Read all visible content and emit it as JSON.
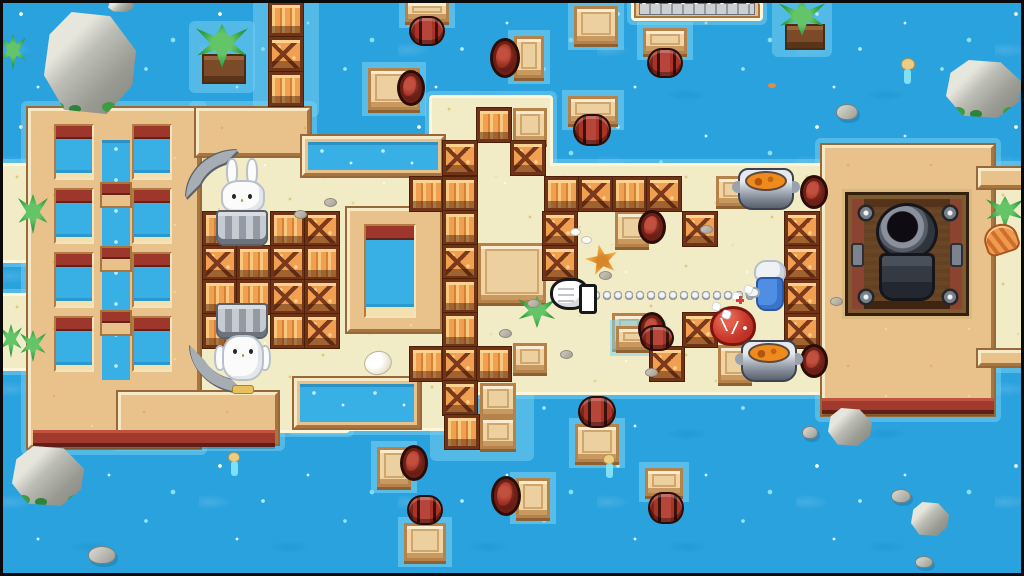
{
  "meta": {
    "description": "Top-down pixel-art beach arena game scene: sand island in blue water with crates, barrels, rafts, rabbits in buckets, a knight firing a spring boxing glove at a red slime, soup pots and a cannon",
    "canvas": {
      "w": 1024,
      "h": 576
    }
  },
  "palette": {
    "water": "#2aa2de",
    "water_sparkle": "#aeeffb",
    "shallow_glow": "#74ceee",
    "sand": "#f2ecc6",
    "sand_rim": "#fcf6dc",
    "wood_platform": "#e9c18a",
    "platform_edge_maroon": "#a03a2c",
    "crate_orange": "#f0a050",
    "crate_frame": "#6f3318",
    "barrel_red": "#a83326",
    "pool_water": "#38b0e6",
    "rock_gray": "#b8b9b1",
    "leaf_green": "#2f9e44",
    "metal_gray": "#a7adb4",
    "knight_blue": "#4f8ee2",
    "slime_red": "#c8392b",
    "soup_orange": "#ef8a1d",
    "rabbit_white": "#fbfbfb",
    "bucket_gray": "#949aa3"
  },
  "scene": {
    "islands": [
      [
        187,
        148,
        160,
        282
      ],
      [
        306,
        166,
        534,
        226
      ],
      [
        432,
        98,
        118,
        80
      ],
      [
        294,
        376,
        152,
        52
      ],
      [
        986,
        184,
        38,
        172
      ],
      [
        0,
        166,
        48,
        94
      ],
      [
        0,
        296,
        42,
        72
      ],
      [
        634,
        0,
        126,
        18
      ]
    ],
    "platforms": [
      [
        28,
        108,
        172,
        340
      ],
      [
        196,
        108,
        114,
        48
      ],
      [
        118,
        392,
        160,
        52
      ],
      [
        822,
        145,
        172,
        270
      ],
      [
        978,
        168,
        46,
        20
      ],
      [
        978,
        350,
        46,
        16
      ]
    ],
    "glow_extra": [
      [
        260,
        0,
        52,
        110
      ],
      [
        437,
        374,
        90,
        80
      ],
      [
        196,
        28,
        52,
        58
      ],
      [
        779,
        0,
        46,
        50
      ]
    ],
    "objects": [
      {
        "type": "pier",
        "items": [
          [
            634,
            0,
            126,
            18
          ]
        ]
      },
      {
        "type": "tan",
        "items": [
          [
            302,
            136,
            142,
            40
          ],
          [
            294,
            378,
            126,
            50
          ],
          [
            347,
            208,
            96,
            124
          ]
        ]
      },
      {
        "type": "maroon",
        "items": [
          [
            33,
            430,
            242,
            17
          ],
          [
            822,
            398,
            172,
            16
          ]
        ]
      },
      {
        "type": "poolw",
        "items": [
          [
            308,
            142,
            130,
            28
          ],
          [
            300,
            384,
            114,
            38
          ],
          [
            102,
            140,
            28,
            240
          ]
        ]
      },
      {
        "type": "bridge",
        "items": [
          [
            100,
            182
          ],
          [
            100,
            246
          ],
          [
            100,
            310
          ]
        ]
      },
      {
        "type": "window",
        "items": [
          [
            54,
            124
          ],
          [
            132,
            124
          ],
          [
            54,
            188
          ],
          [
            132,
            188
          ],
          [
            54,
            252
          ],
          [
            132,
            252
          ],
          [
            54,
            316
          ],
          [
            132,
            316
          ]
        ]
      },
      {
        "type": "winB",
        "items": [
          [
            364,
            224
          ]
        ]
      },
      {
        "type": "pipe_top",
        "items": [
          [
            186,
            150
          ]
        ]
      },
      {
        "type": "pipe_bottom",
        "items": [
          [
            190,
            346
          ]
        ]
      },
      {
        "type": "cannon",
        "items": [
          [
            845,
            192
          ]
        ]
      },
      {
        "type": "bench",
        "items": [
          [
            513,
            108,
            34,
            36
          ],
          [
            615,
            211,
            34,
            36
          ],
          [
            612,
            313,
            34,
            36
          ],
          [
            716,
            176,
            34,
            30
          ],
          [
            718,
            345,
            34,
            38
          ],
          [
            513,
            343,
            34,
            30
          ],
          [
            480,
            383,
            36,
            34
          ],
          [
            480,
            417,
            36,
            32
          ],
          [
            478,
            243,
            68,
            60
          ]
        ]
      },
      {
        "type": "raft",
        "items": [
          [
            405,
            0,
            44,
            22
          ],
          [
            368,
            68,
            52,
            42
          ],
          [
            514,
            36,
            30,
            42
          ],
          [
            574,
            6,
            44,
            38
          ],
          [
            643,
            28,
            44,
            26
          ],
          [
            568,
            96,
            50,
            28
          ],
          [
            616,
            326,
            44,
            24
          ],
          [
            575,
            424,
            44,
            38
          ],
          [
            377,
            447,
            34,
            40
          ],
          [
            516,
            478,
            34,
            40
          ],
          [
            404,
            523,
            42,
            38
          ],
          [
            645,
            468,
            38,
            28
          ]
        ]
      },
      {
        "type": "crate",
        "items": [
          [
            269,
            2,
            "planks"
          ],
          [
            269,
            37,
            "cross"
          ],
          [
            269,
            72,
            "planks"
          ],
          [
            203,
            212,
            "planks"
          ],
          [
            271,
            212,
            "planks"
          ],
          [
            305,
            212,
            "cross"
          ],
          [
            203,
            246,
            "cross"
          ],
          [
            237,
            246,
            "planks"
          ],
          [
            271,
            246,
            "cross"
          ],
          [
            305,
            246,
            "planks"
          ],
          [
            203,
            280,
            "planks"
          ],
          [
            237,
            280,
            "planks"
          ],
          [
            271,
            280,
            "cross"
          ],
          [
            305,
            280,
            "cross"
          ],
          [
            203,
            314,
            "planks"
          ],
          [
            271,
            314,
            "planks"
          ],
          [
            305,
            314,
            "cross"
          ],
          [
            477,
            108,
            "planks"
          ],
          [
            443,
            141,
            "cross"
          ],
          [
            511,
            141,
            "cross"
          ],
          [
            410,
            177,
            "planks"
          ],
          [
            443,
            177,
            "planks"
          ],
          [
            545,
            177,
            "planks"
          ],
          [
            579,
            177,
            "cross"
          ],
          [
            613,
            177,
            "planks"
          ],
          [
            647,
            177,
            "cross"
          ],
          [
            543,
            212,
            "cross"
          ],
          [
            543,
            246,
            "cross"
          ],
          [
            443,
            211,
            "planks"
          ],
          [
            443,
            245,
            "cross"
          ],
          [
            443,
            279,
            "planks"
          ],
          [
            443,
            313,
            "planks"
          ],
          [
            683,
            212,
            "cross"
          ],
          [
            683,
            313,
            "cross"
          ],
          [
            785,
            212,
            "cross"
          ],
          [
            785,
            246,
            "cross"
          ],
          [
            785,
            280,
            "cross"
          ],
          [
            785,
            314,
            "cross"
          ],
          [
            410,
            347,
            "planks"
          ],
          [
            443,
            347,
            "cross"
          ],
          [
            477,
            347,
            "planks"
          ],
          [
            650,
            347,
            "cross"
          ],
          [
            443,
            381,
            "cross"
          ],
          [
            445,
            415,
            "planks"
          ]
        ]
      },
      {
        "type": "barrel_end",
        "items": [
          [
            397,
            70
          ],
          [
            490,
            38,
            30,
            40
          ],
          [
            400,
            445
          ],
          [
            491,
            476,
            30,
            40
          ],
          [
            638,
            210,
            28,
            34
          ],
          [
            638,
            312,
            28,
            34
          ],
          [
            800,
            175,
            28,
            34
          ],
          [
            800,
            344,
            28,
            34
          ]
        ]
      },
      {
        "type": "barrel_h",
        "items": [
          [
            409,
            16
          ],
          [
            647,
            48
          ],
          [
            573,
            114,
            38,
            32
          ],
          [
            640,
            325,
            34,
            26
          ],
          [
            578,
            396,
            38,
            32
          ],
          [
            407,
            495
          ],
          [
            648,
            492,
            36,
            32
          ]
        ]
      },
      {
        "type": "rock",
        "items": [
          [
            44,
            12,
            92,
            102,
            "moss"
          ],
          [
            108,
            0,
            26,
            12
          ],
          [
            946,
            60,
            76,
            58,
            "moss"
          ],
          [
            12,
            446,
            72,
            60,
            "moss"
          ],
          [
            828,
            408,
            44,
            38
          ],
          [
            911,
            502,
            38,
            34
          ]
        ]
      },
      {
        "type": "pebble",
        "items": [
          [
            836,
            104,
            22,
            16
          ],
          [
            88,
            546,
            28,
            18
          ],
          [
            802,
            426,
            16,
            13
          ],
          [
            891,
            489,
            20,
            14
          ],
          [
            915,
            556,
            18,
            12
          ]
        ]
      },
      {
        "type": "soil",
        "items": [
          [
            202,
            54,
            44,
            30
          ],
          [
            785,
            24,
            40,
            26
          ]
        ]
      },
      {
        "type": "palm",
        "items": [
          [
            196,
            24,
            52,
            44
          ],
          [
            779,
            0,
            46,
            36
          ],
          [
            986,
            196,
            38,
            32
          ]
        ]
      },
      {
        "type": "weed",
        "items": [
          [
            0,
            34,
            26,
            36
          ],
          [
            18,
            194,
            30,
            40
          ],
          [
            0,
            324,
            22,
            34
          ],
          [
            20,
            330,
            26,
            32
          ],
          [
            518,
            296,
            38,
            32
          ]
        ]
      },
      {
        "type": "shell",
        "items": [
          [
            984,
            224
          ]
        ]
      },
      {
        "type": "shellS",
        "items": [
          [
            570,
            228
          ],
          [
            581,
            236
          ]
        ]
      },
      {
        "type": "egg",
        "items": [
          [
            364,
            351
          ]
        ]
      },
      {
        "type": "star",
        "items": [
          [
            585,
            244
          ]
        ]
      },
      {
        "type": "sandpebble",
        "items": [
          [
            294,
            210
          ],
          [
            324,
            198
          ],
          [
            527,
            299
          ],
          [
            599,
            271
          ],
          [
            700,
            225
          ],
          [
            560,
            350
          ],
          [
            645,
            368
          ],
          [
            830,
            297
          ],
          [
            499,
            329
          ]
        ]
      },
      {
        "type": "duck",
        "items": [
          [
            228,
            452
          ],
          [
            603,
            454
          ],
          [
            901,
            58,
            14,
            12
          ]
        ]
      },
      {
        "type": "fish",
        "items": [
          [
            768,
            83
          ]
        ]
      },
      {
        "type": "rabbit_up",
        "items": [
          [
            214,
            158
          ]
        ]
      },
      {
        "type": "rabbit_down",
        "items": [
          [
            213,
            301
          ]
        ]
      },
      {
        "type": "slime",
        "items": [
          [
            710,
            306
          ]
        ]
      },
      {
        "type": "cookpot",
        "items": [
          [
            738,
            168
          ],
          [
            741,
            340
          ]
        ]
      },
      {
        "type": "spring",
        "items": [
          [
            590,
            287
          ]
        ]
      },
      {
        "type": "glove",
        "items": [
          [
            550,
            278
          ]
        ]
      },
      {
        "type": "knight",
        "items": [
          [
            750,
            260
          ]
        ]
      },
      {
        "type": "pt_w",
        "items": [
          [
            733,
            293
          ],
          [
            713,
            303
          ],
          [
            723,
            311
          ],
          [
            745,
            286
          ]
        ]
      },
      {
        "type": "pt_r",
        "items": [
          [
            736,
            296
          ]
        ]
      }
    ]
  }
}
